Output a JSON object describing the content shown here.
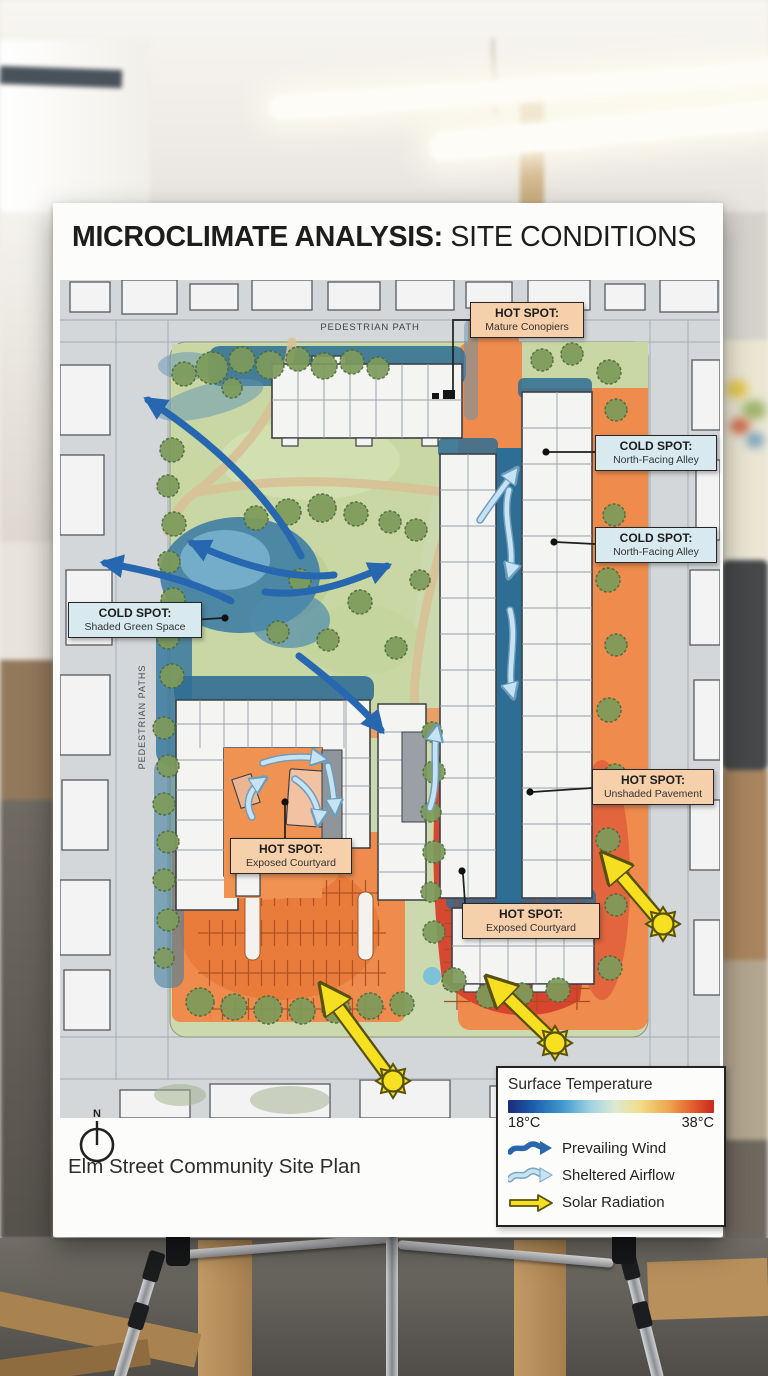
{
  "poster": {
    "title": {
      "bold": "MICROCLIMATE ANALYSIS:",
      "regular": "SITE CONDITIONS"
    },
    "caption": "Elm Street Community Site Plan",
    "north_label": "N"
  },
  "map": {
    "street_labels": {
      "top": "PEDESTRIAN PATH",
      "left": "PEDESTRIAN PATHS"
    },
    "callouts": [
      {
        "kind": "hot",
        "title": "HOT SPOT:",
        "subtitle": "Mature Conopiers"
      },
      {
        "kind": "cold",
        "title": "COLD SPOT:",
        "subtitle": "North-Facing Alley"
      },
      {
        "kind": "cold",
        "title": "COLD SPOT:",
        "subtitle": "North-Facing Alley"
      },
      {
        "kind": "cold",
        "title": "COLD SPOT:",
        "subtitle": "Shaded Green Space"
      },
      {
        "kind": "hot",
        "title": "HOT SPOT:",
        "subtitle": "Unshaded Pavement"
      },
      {
        "kind": "hot",
        "title": "HOT SPOT:",
        "subtitle": "Exposed Courtyard"
      },
      {
        "kind": "hot",
        "title": "HOT SPOT:",
        "subtitle": "Exposed Courtyard"
      }
    ]
  },
  "legend": {
    "title": "Surface Temperature",
    "scale_min": "18°C",
    "scale_max": "38°C",
    "items": [
      {
        "label": "Prevailing Wind",
        "icon": "wind-arrow-icon",
        "color": "#2b66ad"
      },
      {
        "label": "Sheltered Airflow",
        "icon": "airflow-arrow-icon",
        "color": "#c6e3f3"
      },
      {
        "label": "Solar Radiation",
        "icon": "solar-arrow-icon",
        "color": "#f6df20"
      }
    ]
  },
  "colors": {
    "hot_zone": "#ee8b4d",
    "hot_core": "#c22d1f",
    "cold_zone": "#2e6d94",
    "park_green": "#c9d7a4",
    "prevailing_wind": "#2767b0",
    "sheltered_airflow": "#c6e3f3",
    "solar": "#f6df20",
    "hot_label_bg": "#f6cfab",
    "cold_label_bg": "#d8e9f0"
  }
}
